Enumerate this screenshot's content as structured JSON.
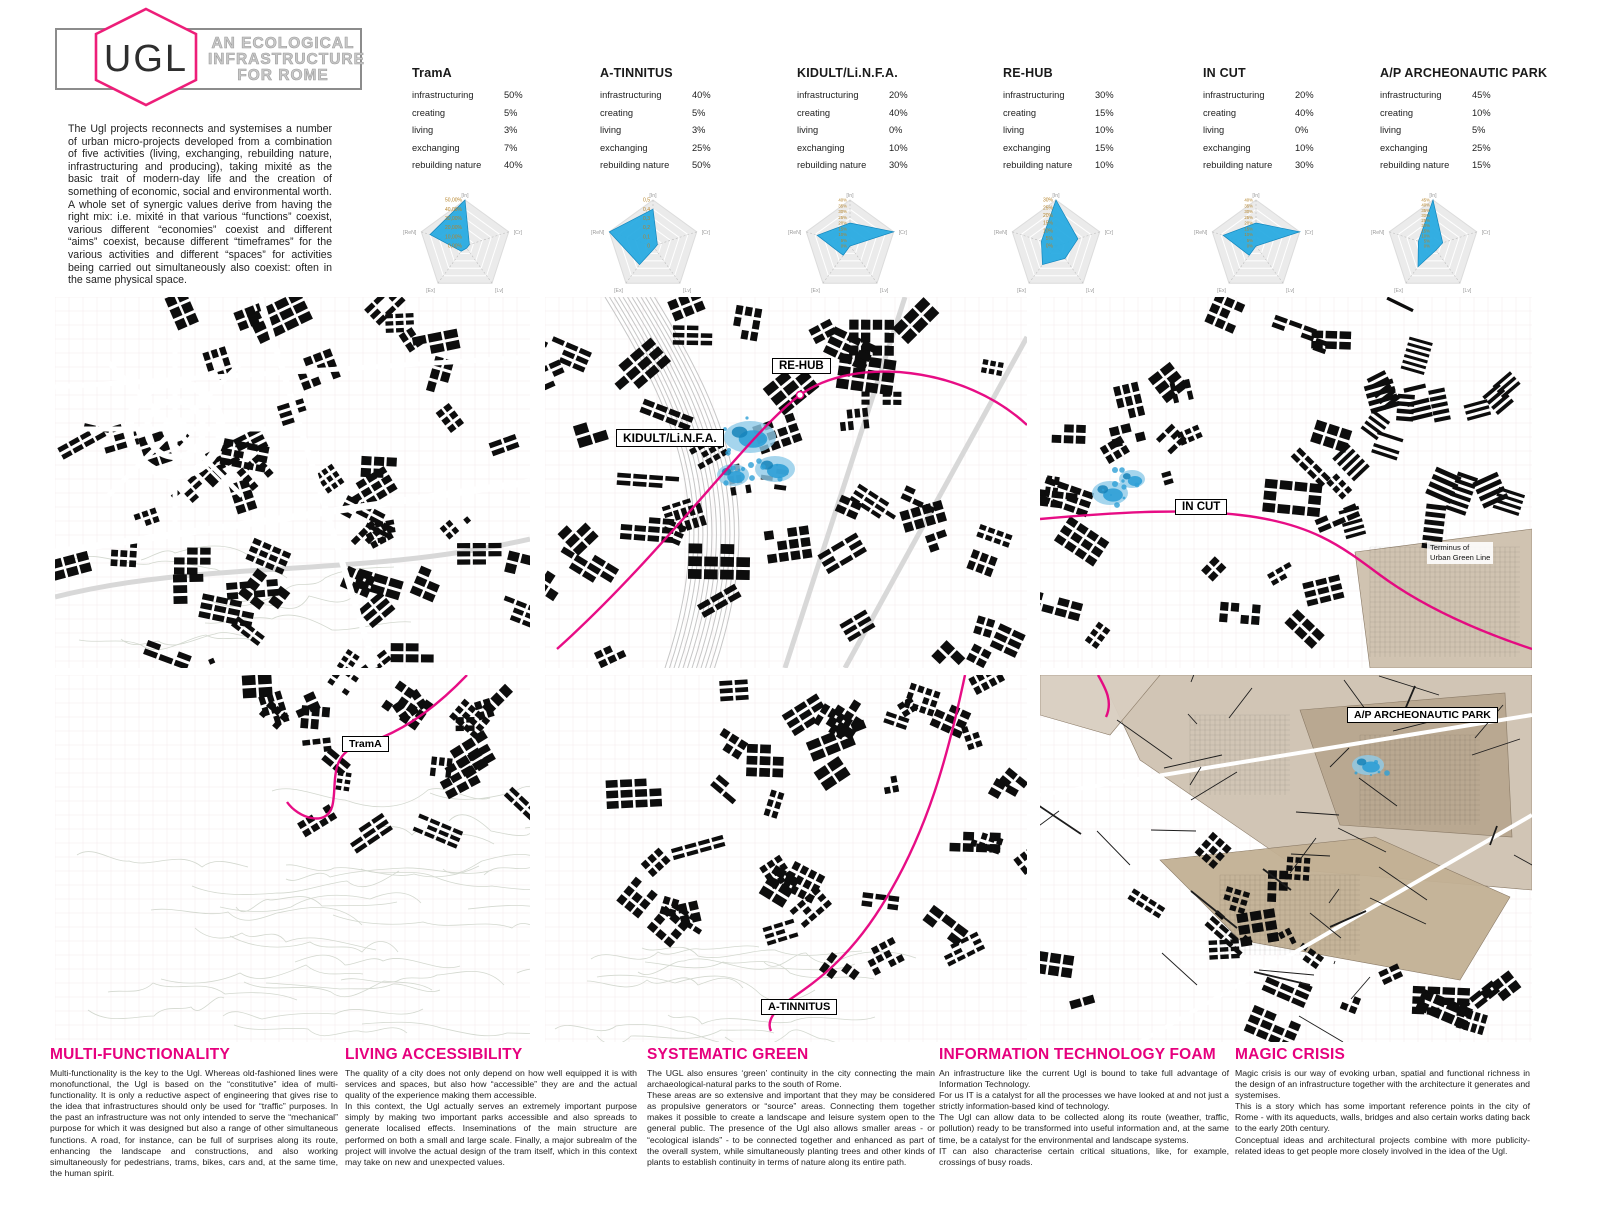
{
  "header": {
    "logo_text": "UGL",
    "subtitle_lines": [
      "AN ECOLOGICAL",
      "INFRASTRUCTURE",
      "FOR ROME"
    ],
    "intro": "The Ugl projects reconnects and systemises a number of urban micro-projects developed from a combination of five activities (living, exchanging, rebuilding nature, infrastructuring and producing), taking mixité as the basic trait of modern-day life and the creation of something of economic, social and environmental worth.\nA whole set of synergic values derive from having the right mix: i.e. mixité in that various “functions” coexist, various different “economies” coexist and different “aims” coexist, because different “timeframes” for the various activities and different “spaces” for activities being carried out simultaneously also coexist: often in the same physical space."
  },
  "metrics_labels": [
    "infrastructuring",
    "creating",
    "living",
    "exchanging",
    "rebuilding nature"
  ],
  "projects": [
    {
      "name": "TramA",
      "values": [
        "50%",
        "5%",
        "3%",
        "7%",
        "40%"
      ]
    },
    {
      "name": "A-TINNITUS",
      "values": [
        "40%",
        "5%",
        "3%",
        "25%",
        "50%"
      ]
    },
    {
      "name": "KIDULT/Li.N.F.A.",
      "values": [
        "20%",
        "40%",
        "0%",
        "10%",
        "30%"
      ]
    },
    {
      "name": "RE-HUB",
      "values": [
        "30%",
        "15%",
        "10%",
        "15%",
        "10%"
      ]
    },
    {
      "name": "IN CUT",
      "values": [
        "20%",
        "40%",
        "0%",
        "10%",
        "30%"
      ]
    },
    {
      "name": "A/P ARCHEONAUTIC PARK",
      "values": [
        "45%",
        "10%",
        "5%",
        "25%",
        "15%"
      ]
    }
  ],
  "radar_axis_labels": [
    "[In]",
    "[Cr]",
    "[Lv]",
    "[Ex]",
    "[ReN]"
  ],
  "chart_data": [
    {
      "type": "radar",
      "title": "TramA",
      "axes": [
        "infrastructuring",
        "creating",
        "living",
        "exchanging",
        "rebuilding nature"
      ],
      "values": [
        50,
        5,
        3,
        7,
        40
      ],
      "max": 50,
      "tick_labels": [
        "50,00%",
        "40,00%",
        "30,00%",
        "20,00%",
        "10,00%",
        "0,00%"
      ]
    },
    {
      "type": "radar",
      "title": "A-TINNITUS",
      "axes": [
        "infrastructuring",
        "creating",
        "living",
        "exchanging",
        "rebuilding nature"
      ],
      "values": [
        40,
        5,
        3,
        25,
        50
      ],
      "max": 50,
      "tick_labels": [
        "0,5",
        "0,4",
        "0,3",
        "0,2",
        "0,1",
        "0"
      ]
    },
    {
      "type": "radar",
      "title": "KIDULT/Li.N.F.A.",
      "axes": [
        "infrastructuring",
        "creating",
        "living",
        "exchanging",
        "rebuilding nature"
      ],
      "values": [
        20,
        40,
        0,
        10,
        30
      ],
      "max": 40,
      "tick_labels": [
        "40%",
        "35%",
        "30%",
        "25%",
        "20%",
        "15%",
        "10%",
        "5%",
        "0%"
      ]
    },
    {
      "type": "radar",
      "title": "RE-HUB",
      "axes": [
        "infrastructuring",
        "creating",
        "living",
        "exchanging",
        "rebuilding nature"
      ],
      "values": [
        30,
        15,
        10,
        15,
        10
      ],
      "max": 30,
      "tick_labels": [
        "30%",
        "25%",
        "20%",
        "15%",
        "10%",
        "5%",
        "0%"
      ]
    },
    {
      "type": "radar",
      "title": "IN CUT",
      "axes": [
        "infrastructuring",
        "creating",
        "living",
        "exchanging",
        "rebuilding nature"
      ],
      "values": [
        20,
        40,
        0,
        10,
        30
      ],
      "max": 40,
      "tick_labels": [
        "40%",
        "35%",
        "30%",
        "25%",
        "20%",
        "15%",
        "10%",
        "5%",
        "0%"
      ]
    },
    {
      "type": "radar",
      "title": "A/P ARCHEONAUTIC PARK",
      "axes": [
        "infrastructuring",
        "creating",
        "living",
        "exchanging",
        "rebuilding nature"
      ],
      "values": [
        45,
        10,
        5,
        25,
        15
      ],
      "max": 45,
      "tick_labels": [
        "45%",
        "40%",
        "35%",
        "30%",
        "25%",
        "20%",
        "15%",
        "10%",
        "5%",
        "0%"
      ]
    }
  ],
  "maps": {
    "panels": [
      {
        "labels": []
      },
      {
        "labels": [
          "RE-HUB",
          "KIDULT/Li.N.F.A."
        ]
      },
      {
        "labels": [
          "IN CUT"
        ],
        "note": "Terminus of\nUrban Green Line"
      },
      {
        "labels": [
          "TramA"
        ]
      },
      {
        "labels": [
          "A-TINNITUS"
        ]
      },
      {
        "labels": [
          "A/P ARCHEONAUTIC PARK"
        ]
      }
    ]
  },
  "sections": [
    {
      "title": "MULTI-FUNCTIONALITY",
      "body": "Multi-functionality is the key to the Ugl. Whereas old-fashioned lines were monofunctional, the Ugl is based on the “constitutive” idea of multi-functionality. It is only a reductive aspect of engineering that gives rise to the idea that infrastructures should only be used for “traffic”  purposes. In the past an infrastructure was not only intended to serve the “mechanical” purpose for which it was designed but also a range of other simultaneous functions. A road, for instance, can be full of surprises along its route, enhancing the landscape and constructions, and also working simultaneously for pedestrians, trams, bikes, cars and, at the same time, the human spirit."
    },
    {
      "title": "LIVING ACCESSIBILITY",
      "body": "The quality of a city does not only depend on how well equipped it is with services and spaces, but also how “accessible” they are and the actual quality of the experience making them accessible.\nIn this context, the Ugl actually serves an extremely important purpose simply by making two important parks accessible and also spreads to generate localised effects. Inseminations of the main structure are performed on both a small and large scale. Finally, a major subrealm of the project will involve the actual design of the tram itself, which in this context may take on new and unexpected values."
    },
    {
      "title": "SYSTEMATIC GREEN",
      "body": "The UGL also ensures ‘green’ continuity in the city connecting the main archaeological-natural parks to the south of Rome.\nThese areas are so extensive and important that they may be considered as propulsive generators or “source” areas. Connecting them together makes it possible to create a landscape and leisure system open to the general public. The presence of the Ugl also allows smaller areas - or “ecological islands” - to be connected together and enhanced as part of the overall system, while simultaneously planting trees and other kinds of plants to establish continuity in terms of nature along its entire path."
    },
    {
      "title": "INFORMATION TECHNOLOGY FOAM",
      "body": "An infrastructure like the current Ugl is bound to take full advantage of Information Technology.\nFor us IT is a catalyst for all the processes we have looked at and not just a strictly information-based kind of technology.\nThe Ugl can allow data to be collected along its route (weather, traffic, pollution) ready to be transformed into useful information and, at the same time, be a catalyst for the environmental and landscape systems.\nIT can also characterise certain critical situations, like, for example, crossings of busy roads."
    },
    {
      "title": "MAGIC CRISIS",
      "body": "Magic crisis is our way of evoking urban, spatial and functional richness in the design of an infrastructure together with the architecture it generates and systemises.\nThis is a story which has some important reference points in the city of Rome - with its aqueducts, walls, bridges and also certain works dating back to the early 20th century.\nConceptual ideas and architectural projects combine with more publicity-related ideas to get people more closely involved in the idea of the Ugl."
    }
  ],
  "colors": {
    "accent": "#e6007e",
    "logo_pink": "#ed1e79",
    "heading_pink": "#e6007e",
    "radar_blue": "#29abe2",
    "map_blue": "#2d9fd6",
    "tan": "#cdc0ad"
  }
}
